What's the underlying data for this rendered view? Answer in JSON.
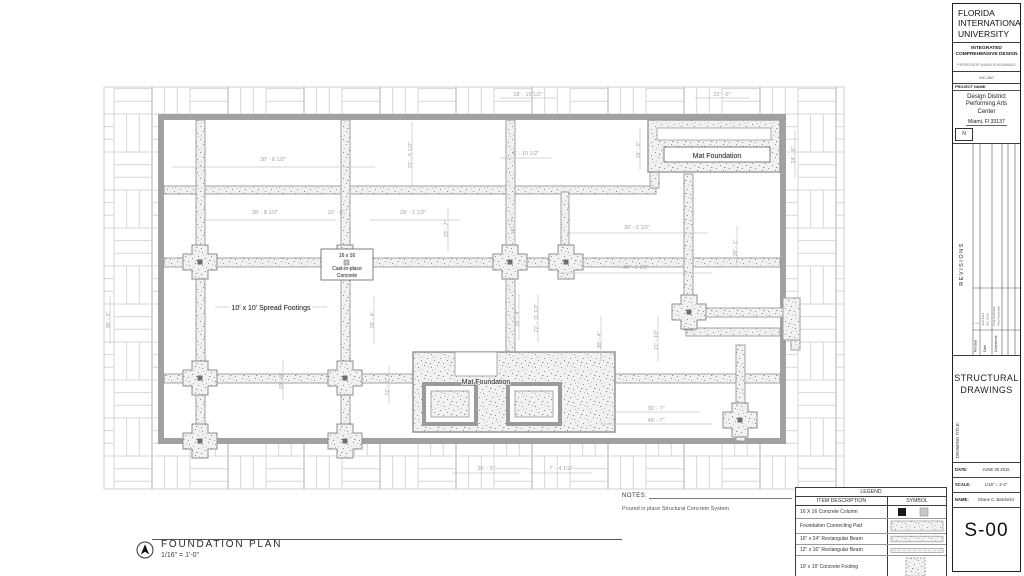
{
  "colors": {
    "wall_gray": "#a1a1a1",
    "hatch_line": "#d7d7d7",
    "dim_text": "#a3a3a3",
    "ink": "#1f1f1f"
  },
  "view": {
    "title": "FOUNDATION PLAN",
    "scale": "1/16\" = 1'-0\""
  },
  "notes": {
    "heading": "NOTES:",
    "body": "Poured in place Structural Concrete System"
  },
  "legend": {
    "title": "LEGEND",
    "columns": [
      "ITEM DESCRIPTION",
      "SYMBOL"
    ],
    "rows": [
      {
        "item": "16 X 16 Concrete Column"
      },
      {
        "item": "Foundation Connecting Pad"
      },
      {
        "item": "16\" x 24\" Rectangular Beam"
      },
      {
        "item": "12\" x 16\" Rectangular Beam"
      },
      {
        "item": "10' x 10' Concrete Footing"
      }
    ]
  },
  "title_block": {
    "university": [
      "FLORIDA",
      "INTERNATIONAL",
      "UNIVERSITY"
    ],
    "program": [
      "INTEGRATED",
      "COMPREHENSIVE DESIGN"
    ],
    "professor": "PROFESSOR NAKIN SUKSAWANG",
    "course_code": "MC-280",
    "project_label": "PROJECT NAME:",
    "project_name": [
      "Design District",
      "Performing Arts",
      "Center"
    ],
    "project_city": "Miami, Fl 33137",
    "north_label": "N",
    "revisions": {
      "title": "REVISIONS",
      "columns": [
        "Revised",
        "Date",
        "Comments"
      ],
      "entries": [
        {
          "revised": "1",
          "date": "JUN 2015",
          "comment": "Prog Submittal"
        },
        {
          "revised": "2",
          "date": "JUL 2015",
          "comment": "Final Submittal"
        }
      ]
    },
    "discipline": [
      "STRUCTURAL",
      "DRAWINGS"
    ],
    "drawing_title_label": "DRAWING TITLE:",
    "fields": [
      {
        "label": "DATE:",
        "value": "JUNE 05 2015"
      },
      {
        "label": "SCALE:",
        "value": "1/16\" = 1'-0\""
      },
      {
        "label": "NAME:",
        "value": "Shane C. Batchelor"
      }
    ],
    "sheet_number": "S-00"
  },
  "plan": {
    "labels": [
      {
        "text": "Mat Foundation",
        "x": 717,
        "y": 158,
        "size": 7,
        "box": [
          664,
          147,
          106,
          15
        ]
      },
      {
        "text": "16 x 16",
        "x": 347,
        "y": 257,
        "size": 5,
        "box": [
          321,
          249,
          52,
          31
        ]
      },
      {
        "text": "Cast-in-place",
        "x": 347,
        "y": 270,
        "size": 5
      },
      {
        "text": "Concrete",
        "x": 347,
        "y": 277,
        "size": 5
      },
      {
        "text": "10' x 10' Spread Footings",
        "x": 271,
        "y": 310,
        "size": 7
      },
      {
        "text": "Mat Foundation",
        "x": 486,
        "y": 384,
        "size": 7
      }
    ],
    "dimensions": [
      {
        "text": "18' - 10 1/2\"",
        "x": 528,
        "y": 96
      },
      {
        "text": "22' - 6\"",
        "x": 722,
        "y": 96
      },
      {
        "text": "38' - 8 1/2\"",
        "x": 273,
        "y": 161
      },
      {
        "text": "21' - 5 1/2\"",
        "x": 412,
        "y": 155,
        "rot": -90
      },
      {
        "text": "8' - 10 1/2\"",
        "x": 526,
        "y": 155
      },
      {
        "text": "16' - 0\"",
        "x": 640,
        "y": 150,
        "rot": -90
      },
      {
        "text": "24' - 6\"",
        "x": 795,
        "y": 155,
        "rot": -90
      },
      {
        "text": "28' - 8 1/2\"",
        "x": 265,
        "y": 214
      },
      {
        "text": "10' - 0\"",
        "x": 336,
        "y": 214
      },
      {
        "text": "29' - 1 1/2\"",
        "x": 413,
        "y": 214
      },
      {
        "text": "20' - 7\"",
        "x": 448,
        "y": 229,
        "rot": -90
      },
      {
        "text": "16' - 7\"",
        "x": 515,
        "y": 226,
        "rot": -90
      },
      {
        "text": "30' - 2 1/2\"",
        "x": 637,
        "y": 229
      },
      {
        "text": "26' - 1\"",
        "x": 737,
        "y": 248,
        "rot": -90
      },
      {
        "text": "40' - 2 1/2\"",
        "x": 636,
        "y": 269
      },
      {
        "text": "36' - 5\"",
        "x": 110,
        "y": 320,
        "rot": -90
      },
      {
        "text": "26' - 4\"",
        "x": 374,
        "y": 320,
        "rot": -90
      },
      {
        "text": "26' - 4\"",
        "x": 519,
        "y": 318,
        "rot": -90
      },
      {
        "text": "22' - 11 1/2\"",
        "x": 538,
        "y": 318,
        "rot": -90
      },
      {
        "text": "30' - 4\"",
        "x": 601,
        "y": 340,
        "rot": -90
      },
      {
        "text": "21' - 10\"",
        "x": 658,
        "y": 340,
        "rot": -90
      },
      {
        "text": "10' - 0\"",
        "x": 283,
        "y": 381,
        "rot": -90
      },
      {
        "text": "22' - 0\"",
        "x": 389,
        "y": 387,
        "rot": -90
      },
      {
        "text": "39' - 7\"",
        "x": 656,
        "y": 410
      },
      {
        "text": "49' - 7\"",
        "x": 656,
        "y": 422
      },
      {
        "text": "36' - 0\"",
        "x": 486,
        "y": 470
      },
      {
        "text": "7' - 4 1/2\"",
        "x": 561,
        "y": 470
      }
    ]
  }
}
